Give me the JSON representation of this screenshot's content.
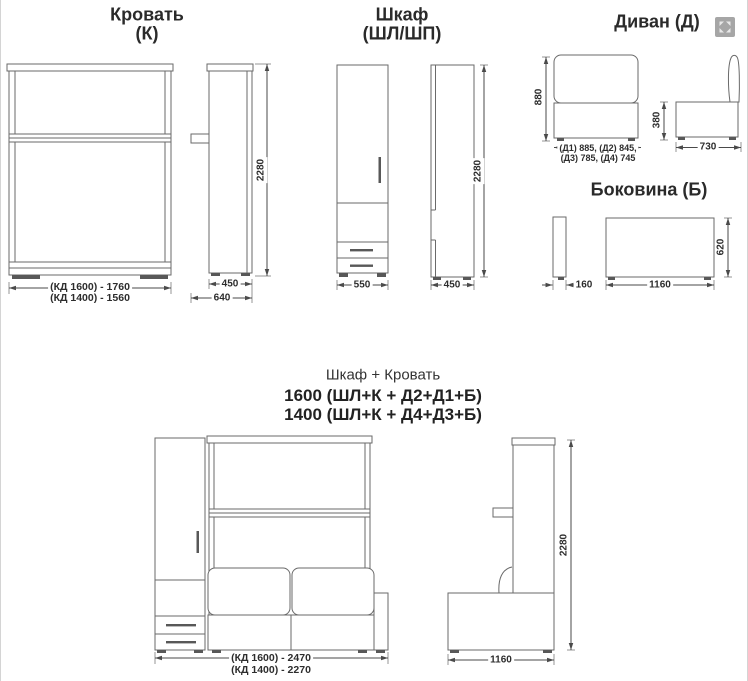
{
  "bed": {
    "title": "Кровать",
    "subtitle": "(К)",
    "front": {
      "dim_w1600": "(КД 1600) - 1760",
      "dim_w1400": "(КД 1400) - 1560"
    },
    "side": {
      "dim_width": "450",
      "dim_depth": "640",
      "dim_height": "2280"
    }
  },
  "wardrobe": {
    "title": "Шкаф",
    "subtitle": "(ШЛ/ШП)",
    "front": {
      "dim_width": "550"
    },
    "side": {
      "dim_width": "450",
      "dim_height": "2280"
    }
  },
  "sofa": {
    "title": "Диван  (Д)",
    "front": {
      "dim_height": "880",
      "dim_widths_1": "(Д1) 885, (Д2) 845,",
      "dim_widths_2": "(Д3) 785, (Д4) 745"
    },
    "side": {
      "dim_height": "380",
      "dim_depth": "730"
    }
  },
  "side_panel": {
    "title": "Боковина (Б)",
    "edge": {
      "dim_thickness": "160"
    },
    "front": {
      "dim_width": "1160",
      "dim_height": "620"
    }
  },
  "combo": {
    "heading": "Шкаф + Кровать",
    "variant_1600": "1600 (ШЛ+К + Д2+Д1+Б)",
    "variant_1400": "1400 (ШЛ+К + Д4+Д3+Б)",
    "front": {
      "dim_w1600": "(КД 1600) - 2470",
      "dim_w1400": "(КД 1400) - 2270"
    },
    "side": {
      "dim_width": "1160",
      "dim_height": "2280"
    }
  },
  "icon": {
    "watermark": "expand-arrows"
  }
}
